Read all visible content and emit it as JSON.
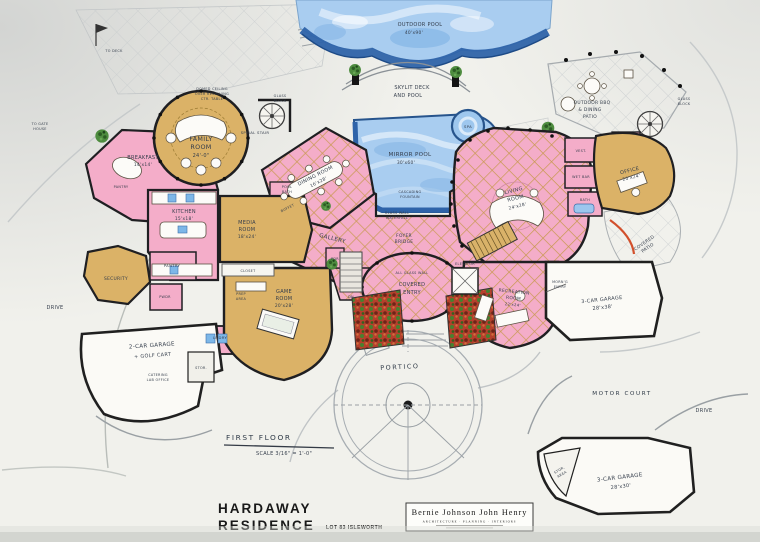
{
  "titles": {
    "first_floor": "FIRST FLOOR",
    "scale": "SCALE 3/16\" = 1'-0\"",
    "project_l1": "HARDAWAY",
    "project_l2": "RESIDENCE",
    "lot": "LOT 83 ISLEWORTH"
  },
  "firm": {
    "name": "Bernie Johnson  John Henry",
    "tagline": "ARCHITECTURE · PLANNING · INTERIORS"
  },
  "site": {
    "portico": "PORTICO",
    "motor_court": "MOTOR COURT",
    "drive_w": "DRIVE",
    "drive_e": "DRIVE",
    "to_deck": "TO DECK",
    "to_gate_l1": "TO GATE",
    "to_gate_l2": "HOUSE"
  },
  "pool": {
    "outdoor_l1": "OUTDOOR POOL",
    "outdoor_l2": "40'x90'",
    "skylit_l1": "SKYLIT DECK",
    "skylit_l2": "AND POOL",
    "mirror_l1": "MIRROR POOL",
    "mirror_l2": "30'x60'",
    "fountain_l1": "CASCADING",
    "fountain_l2": "FOUNTAIN",
    "spa": "SPA",
    "bbq_l1": "OUTDOOR BBQ",
    "bbq_l2": "& DINING",
    "bbq_l3": "PATIO",
    "glass_block_l1": "GLASS",
    "glass_block_l2": "BLOCK"
  },
  "rooms": {
    "family_l1": "FAMILY",
    "family_l2": "ROOM",
    "family_l3": "24'-0\"",
    "dome_l1": "DOMED CEILING",
    "dome_l2": "OVER REVOLVING",
    "dome_l3": "CTR. TABLE",
    "spiral": "SPIRAL STAIR",
    "glass1_l1": "GLASS",
    "glass1_l2": "BLOCK",
    "breakfast_l1": "BREAKFAST",
    "breakfast_l2": "14'x14'",
    "kitchen_l1": "KITCHEN",
    "kitchen_l2": "15'x18'",
    "pantry1": "PANTRY",
    "pantry2": "PANTRY",
    "pwdr": "PWDR",
    "pdr": "PDR",
    "media_l1": "MEDIA",
    "media_l2": "ROOM",
    "media_l3": "18'x24'",
    "closet": "CLOSET",
    "game_l1": "GAME",
    "game_l2": "ROOM",
    "game_l3": "20'x28'",
    "prep_l1": "PREP",
    "prep_l2": "AREA",
    "pool_bath_l1": "POOL",
    "pool_bath_l2": "BATH",
    "gallery": "GALLERY",
    "dining_l1": "DINING ROOM",
    "dining_l2": "16'x28'",
    "buffet": "BUFFET",
    "foyer_l1": "FOYER",
    "foyer_l2": "BRIDGE",
    "glasswall_l1": "GLASS WALL",
    "glasswall_l2": "WATERFALL",
    "living_l1": "LIVING",
    "living_l2": "ROOM",
    "living_l3": "24'x28'",
    "office_l1": "OFFICE",
    "office_l2": "20'x24'",
    "vest": "VEST.",
    "wet_bar": "WET BAR",
    "bath": "BATH",
    "rec_l1": "RECREATION",
    "rec_l2": "ROOM",
    "rec_l3": "22'x24'",
    "elevator": "ELEVATOR",
    "dn": "DN",
    "entry_l1": "ALL GLASS WALL",
    "entry_l2": "COVERED",
    "entry_l3": "ENTRY",
    "morning_l1": "MORN'G",
    "morning_l2": "ENTRY",
    "security": "SECURITY",
    "lndry": "LNDRY",
    "stor": "STOR.",
    "garage_w_l1": "2-CAR GARAGE",
    "garage_w_l2": "+ GOLF CART",
    "catering_l1": "CATERING",
    "catering_l2": "LAB OFFICE",
    "garage_e_l1": "3-CAR GARAGE",
    "garage_e_l2": "28'x38'",
    "garage_s_l1": "3-CAR GARAGE",
    "garage_s_l2": "28'x30'",
    "stor_area_l1": "STOR.",
    "stor_area_l2": "AREA"
  },
  "colors": {
    "pink": "#f4adc9",
    "tan": "#dbb267",
    "water": "#a9cdf0",
    "water_edge": "#2e63a9",
    "wall": "#202020",
    "paper": "#f1f1ec"
  }
}
